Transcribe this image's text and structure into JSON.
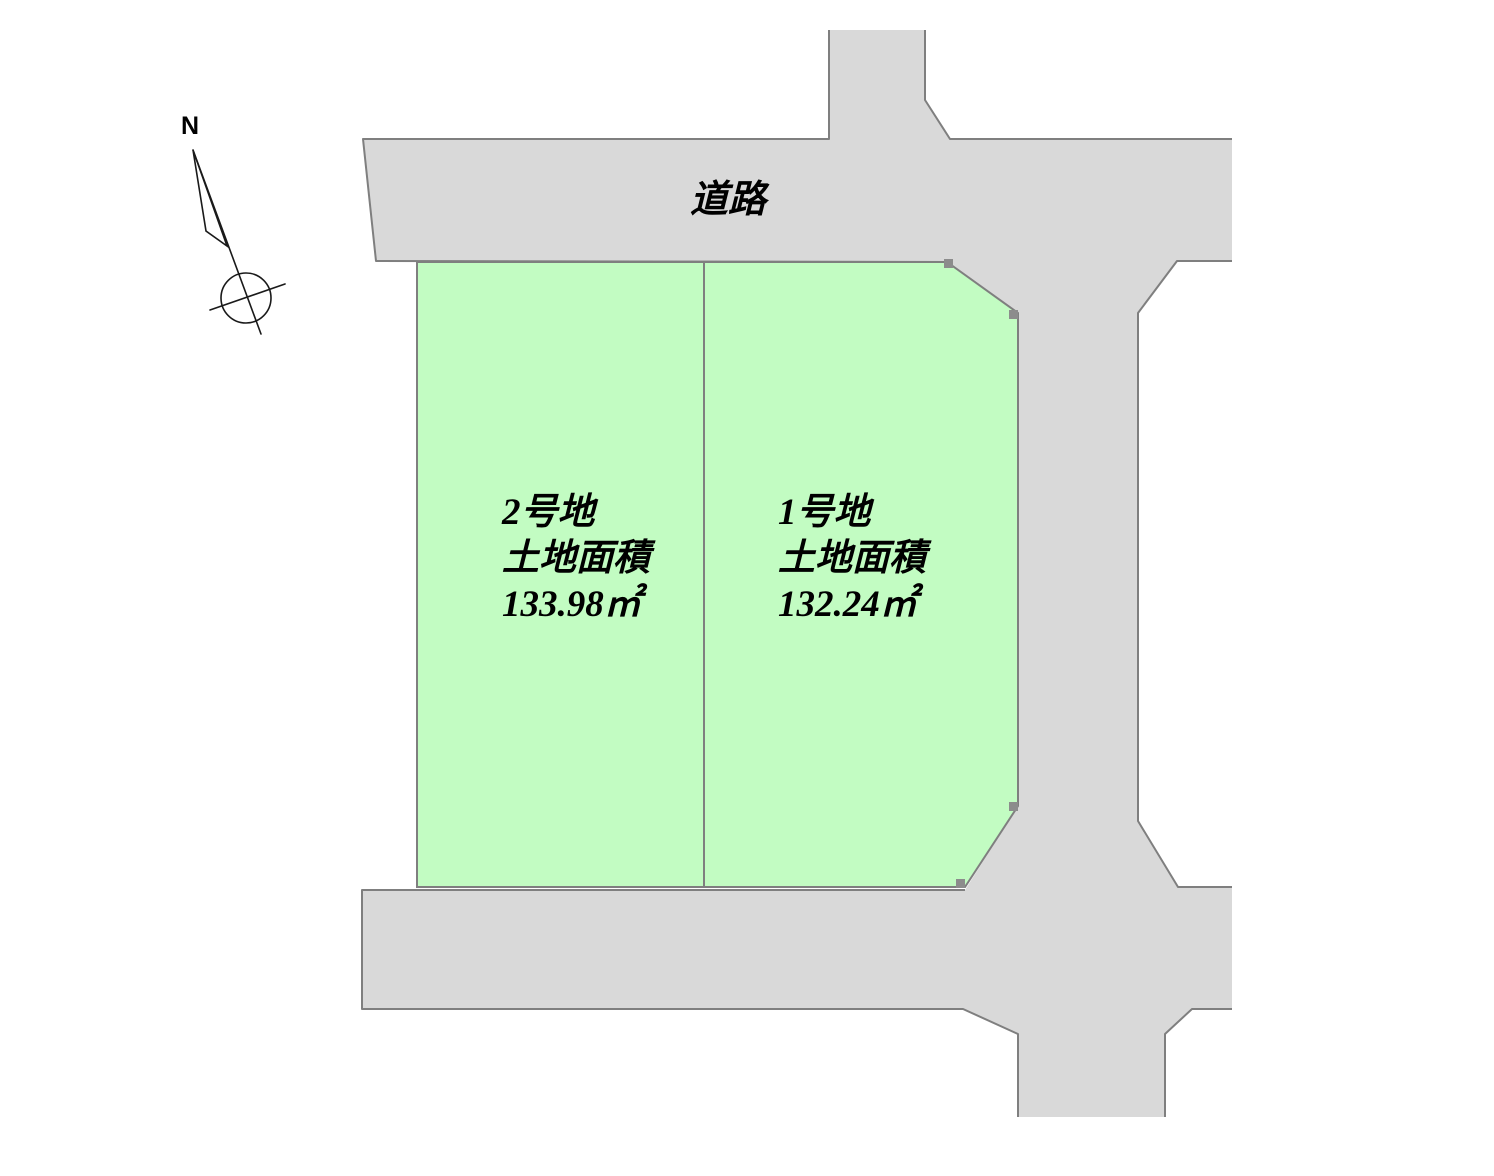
{
  "diagram": {
    "north_label": "N",
    "road_label": "道路",
    "parcels": [
      {
        "id": "parcel-2",
        "name": "2号地",
        "area_label": "土地面積",
        "area_value": "133.98㎡"
      },
      {
        "id": "parcel-1",
        "name": "1号地",
        "area_label": "土地面積",
        "area_value": "132.24㎡"
      }
    ],
    "colors": {
      "road_fill": "#d9d9d9",
      "parcel_fill": "#c2fcc2",
      "outline": "#7f7f7f",
      "marker": "#8c8c8c",
      "compass": "#1a1a1a",
      "text": "#000000",
      "background": "#ffffff"
    }
  }
}
